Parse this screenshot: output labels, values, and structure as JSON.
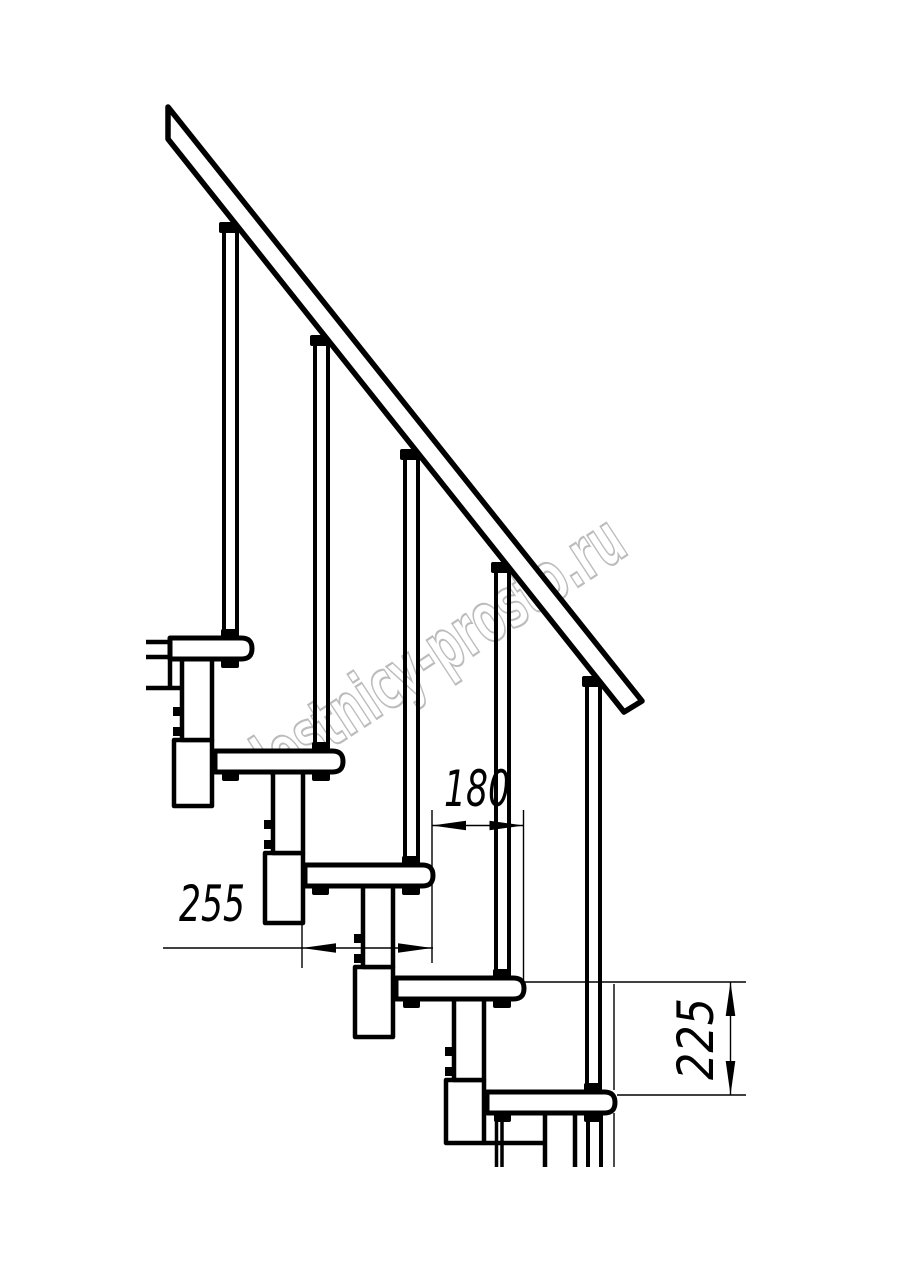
{
  "drawing": {
    "background": "#ffffff",
    "line_color": "#000000",
    "description": "Side-view line drawing of a modular staircase with handrail",
    "steps_visible": 5,
    "balusters_visible": 5
  },
  "watermark": {
    "text": "lestnicy-prosto.ru",
    "color": "#bcbcbc"
  },
  "dimensions": {
    "going": {
      "value": "180",
      "orientation": "horizontal"
    },
    "depth": {
      "value": "255",
      "orientation": "horizontal"
    },
    "rise": {
      "value": "225",
      "orientation": "vertical"
    }
  }
}
